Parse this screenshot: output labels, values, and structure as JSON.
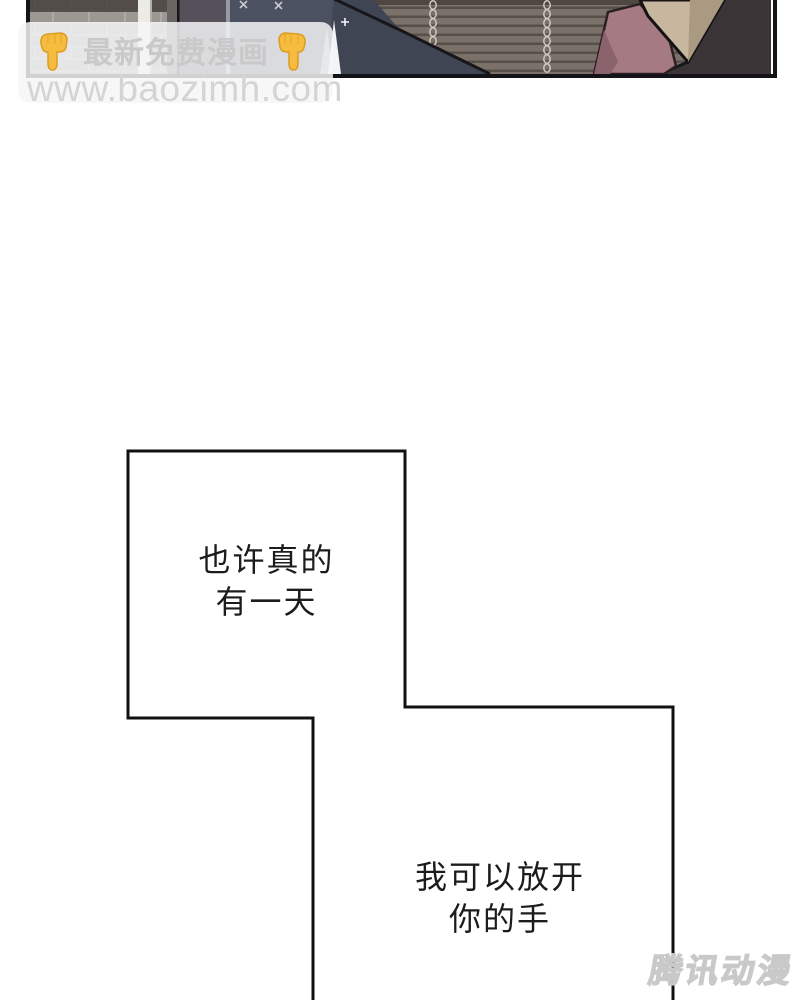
{
  "page": {
    "background_color": "#ffffff",
    "width": 800,
    "height": 1000
  },
  "comic_panel": {
    "description": "cropped manhua panel: brick wall, white post, hanging chain blind, two dark-coated figures and a beige-hooded figure",
    "border_color": "#141418",
    "palette": {
      "wall_gray": "#8d8a86",
      "brick_base": "#9c9894",
      "brick_mortar": "#aeaaa5",
      "brick_top_shadow": "#46403c",
      "white_post": "#edebe6",
      "post_shadow": "#b3b0ab",
      "door_strip": "#6b6663",
      "figure_left_coat": "#55515a",
      "figure_edge_light": "#959aa6",
      "figure_mid_coat": "#4b5160",
      "figure_mid_coat_dark": "#3f4552",
      "figure_outline": "#17171a",
      "gap_wedge_gray": "#9aa0ab",
      "gap_wedge_white": "#f3f4f6",
      "stitch_color": "#c6c9d2",
      "blind_base": "#7b716b",
      "blind_slat_line": "#57504a",
      "blind_top_band": "#4e4742",
      "chain_color": "#cfc9c2",
      "hood_beige": "#c6b79e",
      "hood_beige_shadow": "#a99a81",
      "scarf_mauve": "#a57a82",
      "scarf_mauve_shadow": "#8b636c",
      "jacket_dark": "#3a3437"
    }
  },
  "promo_banner": {
    "label": "最新免费漫画",
    "label_color": "#c9c9c9",
    "background_color": "rgba(246,246,247,0.84)",
    "hand_icon": "backhand-index-pointing-down",
    "hand_fill": "#F5BC40",
    "hand_outline": "#DD9B22"
  },
  "watermarks": {
    "site_url": "www.baozimh.com",
    "site_url_color": "#d4d4d4",
    "corner_logo": "腾讯动漫",
    "corner_logo_color": "#c9c9c9"
  },
  "speech_bubbles": [
    {
      "id": 1,
      "lines": [
        "也许真的",
        "有一天"
      ]
    },
    {
      "id": 2,
      "lines": [
        "我可以放开",
        "你的手"
      ]
    }
  ],
  "bubble_style": {
    "fill": "#ffffff",
    "stroke": "#111111",
    "text_color": "#1c1c1c"
  }
}
